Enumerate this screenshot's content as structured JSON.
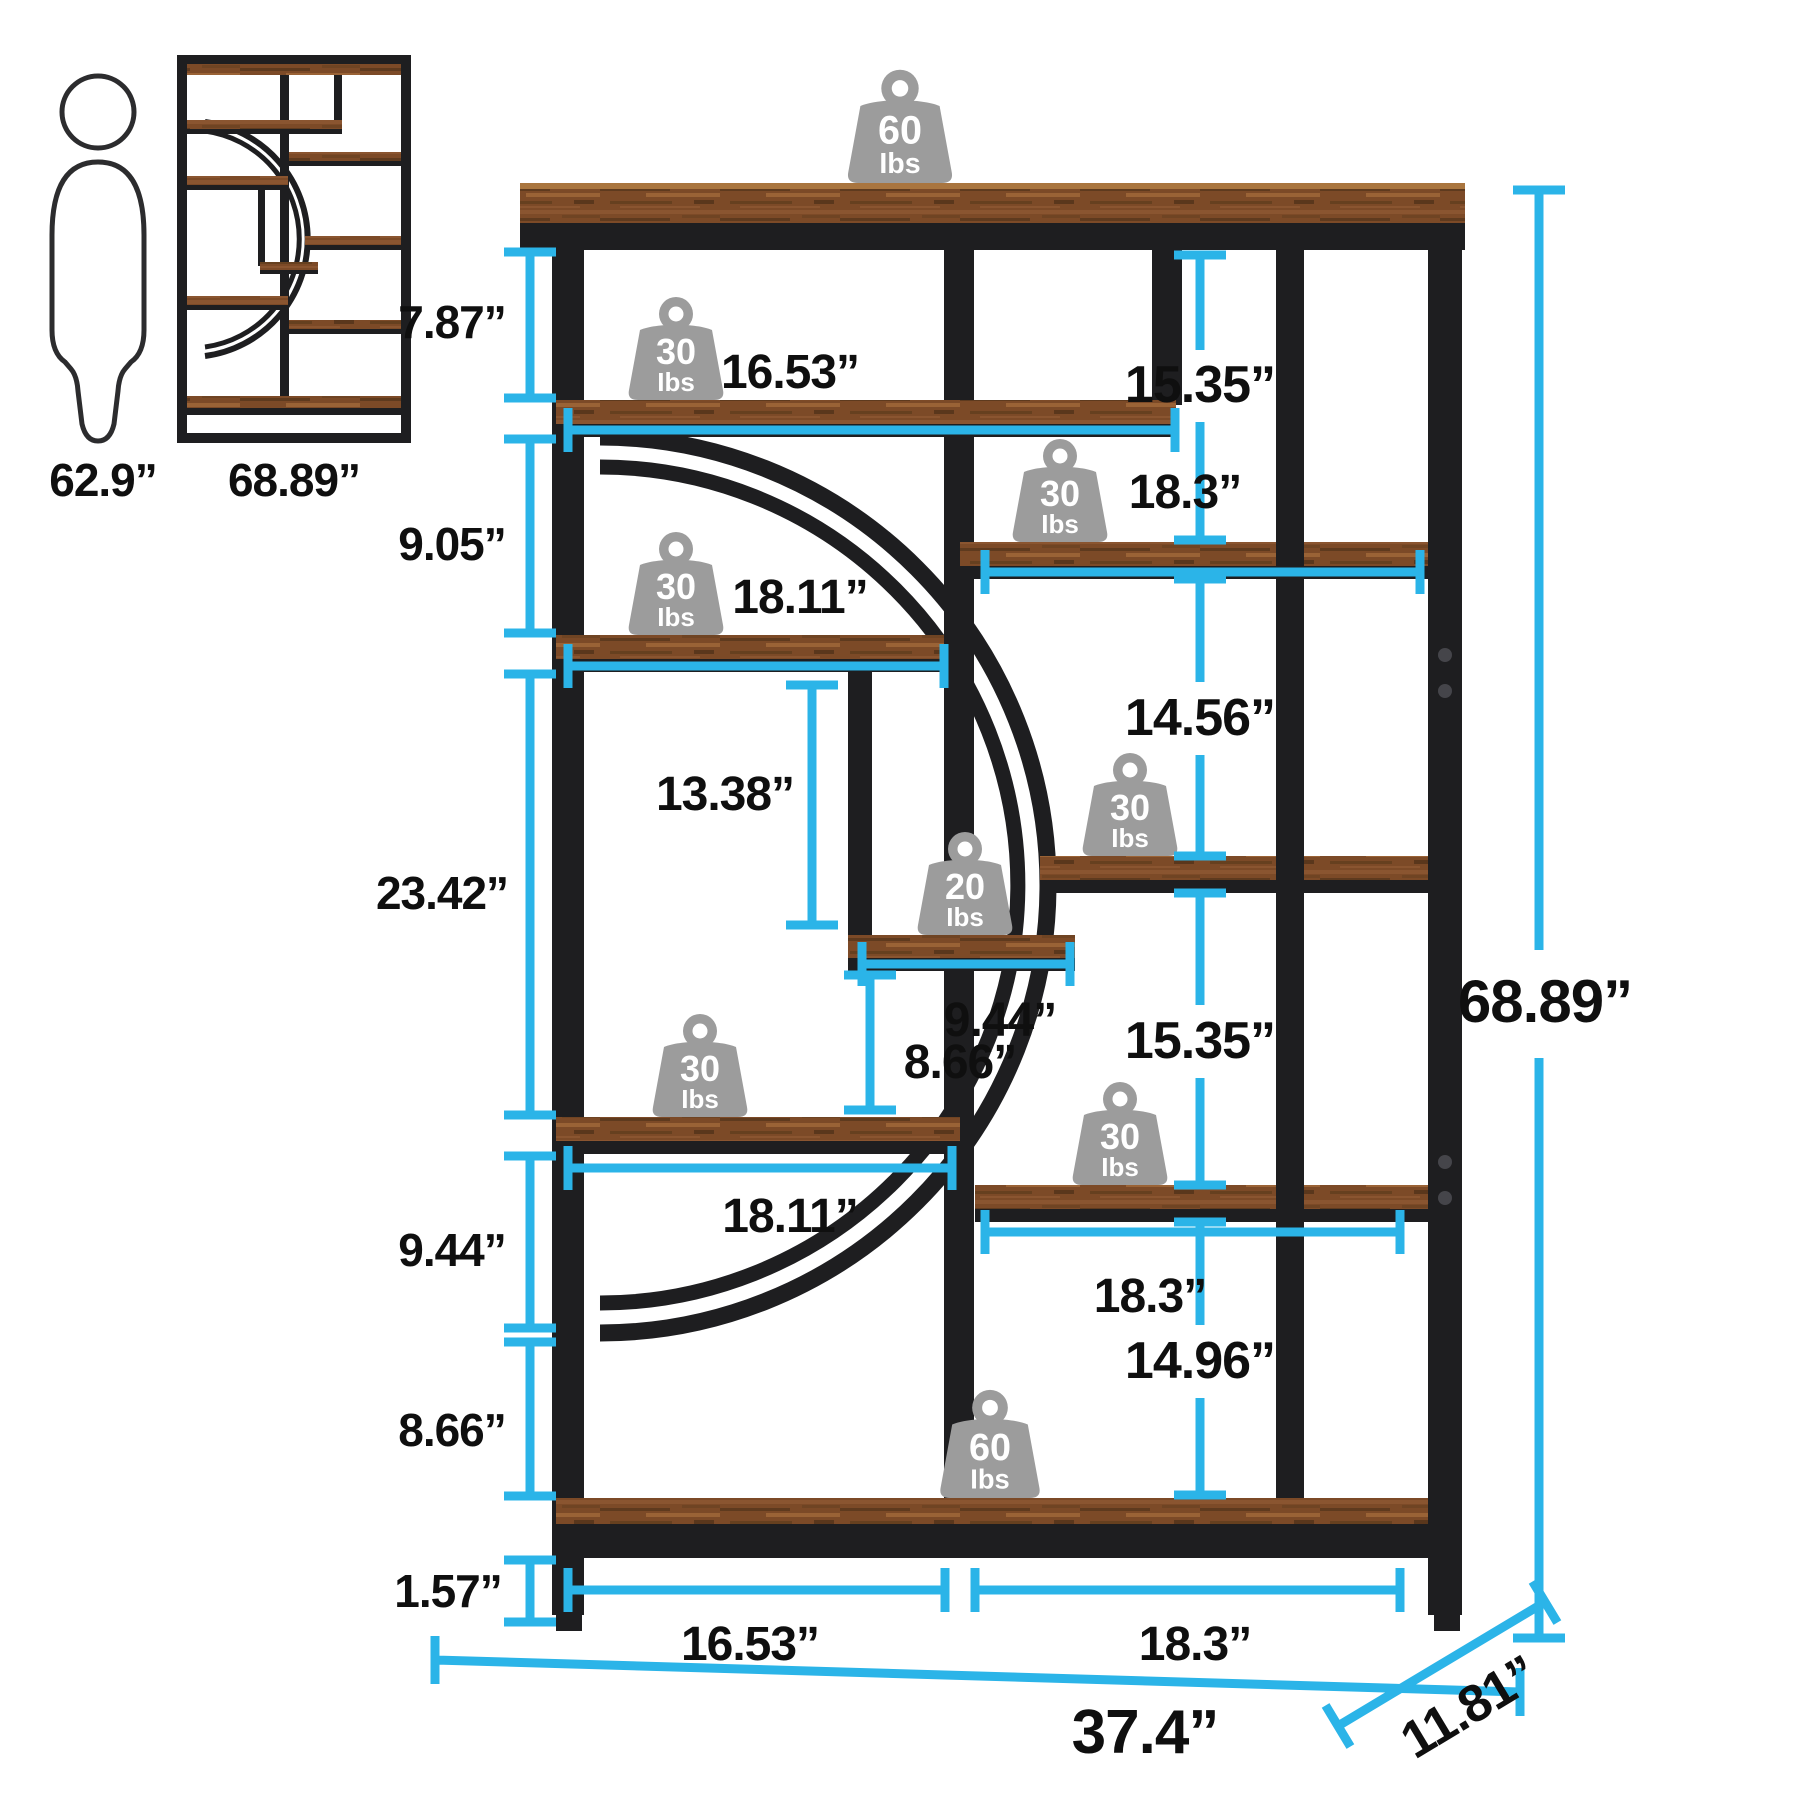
{
  "sidebar": {
    "person_height": "62.9”",
    "unit_height": "68.89”"
  },
  "weights": [
    {
      "location": "top-board",
      "value": "60",
      "unit": "Ibs"
    },
    {
      "location": "upper-left-shelf",
      "value": "30",
      "unit": "Ibs"
    },
    {
      "location": "upper-right-shelf",
      "value": "30",
      "unit": "Ibs"
    },
    {
      "location": "mid-left-shelf",
      "value": "30",
      "unit": "Ibs"
    },
    {
      "location": "center-small-shelf",
      "value": "20",
      "unit": "Ibs"
    },
    {
      "location": "mid-right-shelf",
      "value": "30",
      "unit": "Ibs"
    },
    {
      "location": "lower-left-shelf",
      "value": "30",
      "unit": "Ibs"
    },
    {
      "location": "lower-right-shelf",
      "value": "30",
      "unit": "Ibs"
    },
    {
      "location": "bottom-board",
      "value": "60",
      "unit": "Ibs"
    }
  ],
  "dimensions": {
    "left_heights": {
      "top_gap": "7.87”",
      "second_gap": "9.05”",
      "middle_gap": "23.42”",
      "lower_gap": "9.44”",
      "bottom_gap": "8.66”",
      "base_height": "1.57”"
    },
    "shelf_widths": {
      "upper_left": "16.53”",
      "upper_right": "18.3”",
      "mid_left": "18.11”",
      "center_small": "9.44”",
      "lower_left": "18.11”",
      "lower_right": "18.3”"
    },
    "inner_heights": {
      "post": "13.38”",
      "center_gap": "8.66”"
    },
    "right_heights": {
      "bay1": "15.35”",
      "bay2": "14.56”",
      "bay3": "15.35”",
      "bay4": "14.96”"
    },
    "overall": {
      "height": "68.89”",
      "width": "37.4”",
      "depth": "11.81”",
      "bottom_left": "16.53”",
      "bottom_right": "18.3”"
    }
  },
  "colors": {
    "frame": "#1e1e20",
    "wood": "#7c4a27",
    "dimension": "#2bb4e8",
    "label": "#0f0f0f",
    "weight": "#9c9c9c"
  }
}
